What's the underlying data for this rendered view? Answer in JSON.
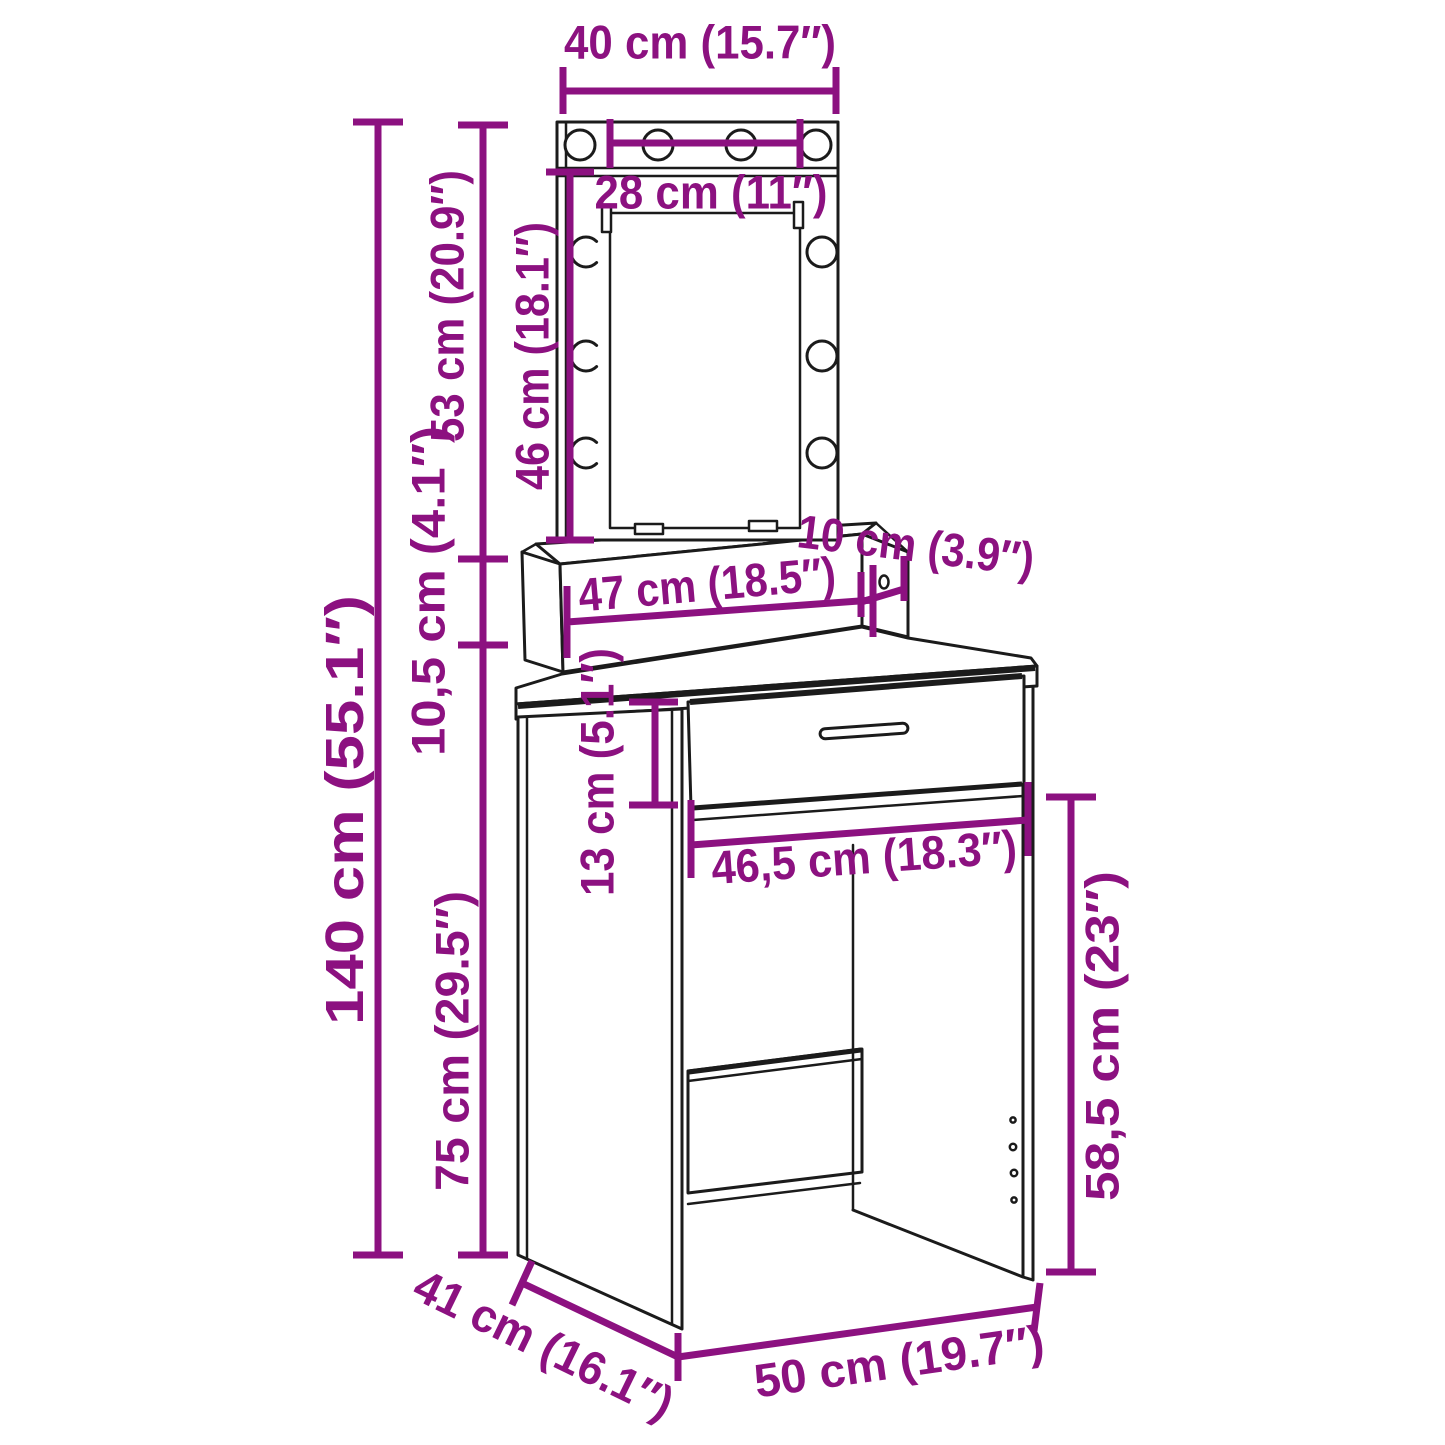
{
  "diagram": {
    "title": "Dressing table with LED mirror - dimension drawing",
    "colors": {
      "dimension_annotation": "#8c1180",
      "line_art": "#1b1b1b",
      "background": "#ffffff"
    },
    "labels": {
      "mirror_outer_width": "40 cm (15.7″)",
      "mirror_inner_width": "28 cm (11″)",
      "mirror_total_height": "53 cm (20.9″)",
      "mirror_glass_height": "46 cm (18.1″)",
      "total_height": "140 cm (55.1″)",
      "riser_height": "10,5 cm (4.1″)",
      "riser_depth": "10 cm (3.9″)",
      "riser_width": "47 cm (18.5″)",
      "drawer_height": "13 cm (5.1″)",
      "opening_width": "46,5 cm (18.3″)",
      "table_height": "75 cm (29.5″)",
      "clearance_height": "58,5 cm (23″)",
      "table_depth": "41 cm (16.1″)",
      "table_width": "50 cm (19.7″)"
    }
  }
}
